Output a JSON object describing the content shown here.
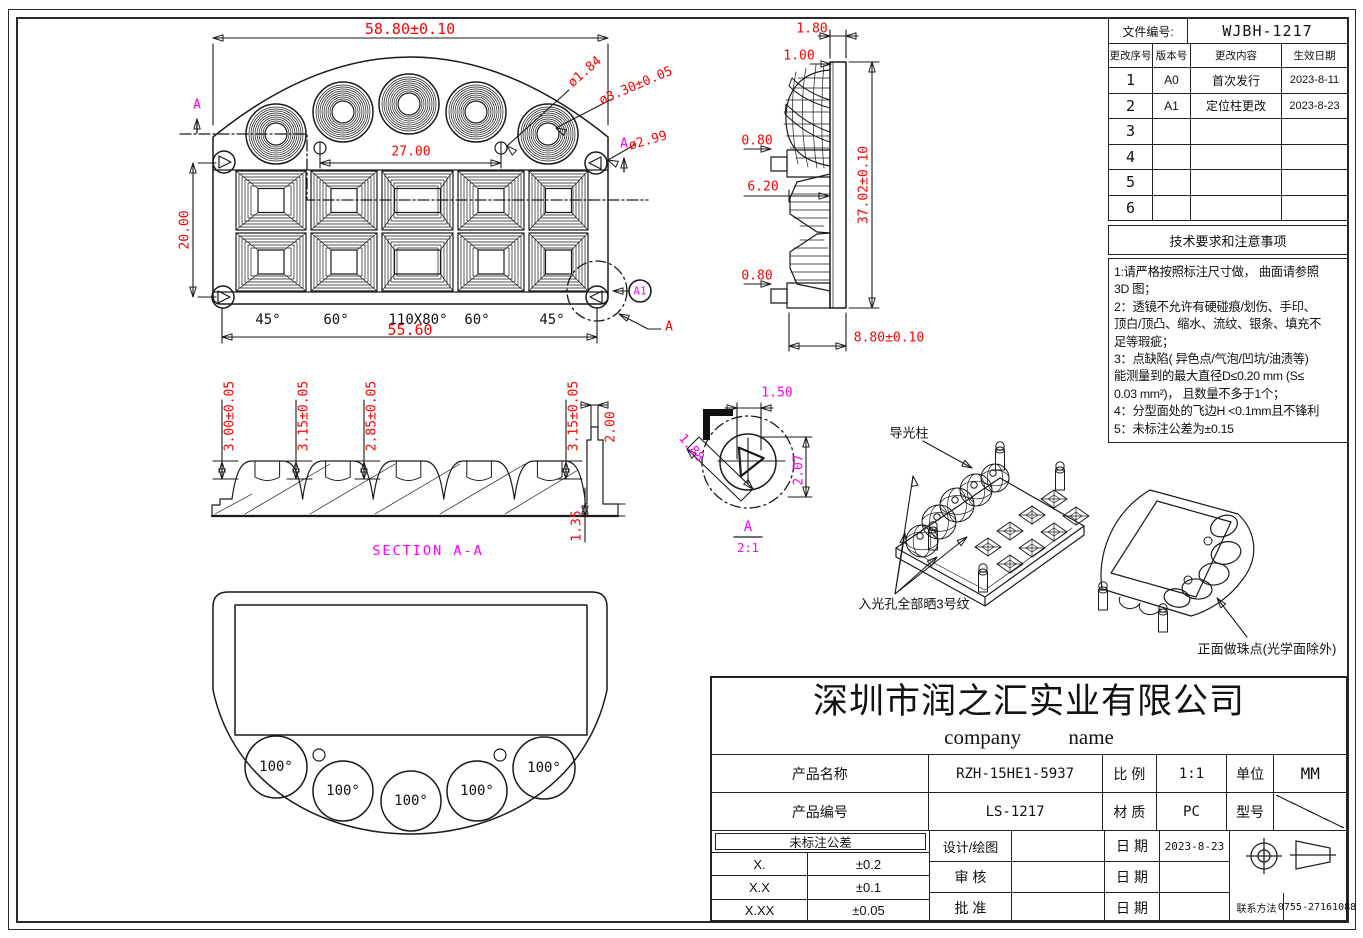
{
  "file_block": {
    "label": "文件编号:",
    "value": "WJBH-1217"
  },
  "revision": {
    "headers": [
      "更改序号",
      "版本号",
      "更改内容",
      "生效日期"
    ],
    "rows": [
      {
        "no": "1",
        "ver": "A0",
        "content": "首次发行",
        "date": "2023-8-11"
      },
      {
        "no": "2",
        "ver": "A1",
        "content": "定位柱更改",
        "date": "2023-8-23"
      },
      {
        "no": "3",
        "ver": "",
        "content": "",
        "date": ""
      },
      {
        "no": "4",
        "ver": "",
        "content": "",
        "date": ""
      },
      {
        "no": "5",
        "ver": "",
        "content": "",
        "date": ""
      },
      {
        "no": "6",
        "ver": "",
        "content": "",
        "date": ""
      }
    ]
  },
  "tech_notes": {
    "title": "技术要求和注意事项",
    "lines": [
      "1:请严格按照标注尺寸做， 曲面请参照",
      "3D 图；",
      "2：透镜不允许有硬碰痕/划伤、手印、",
      "顶白/顶凸、缩水、流纹、银条、填充不",
      "足等瑕疵；",
      "3：点缺陷( 异色点/气泡/凹坑/油渍等)",
      "能测量到的最大直径D≤0.20 mm (S≤",
      "0.03 mm²)，  且数量不多于1个；",
      "4：分型面处的飞边H <0.1mm且不锋利",
      "5：未标注公差为±0.15"
    ]
  },
  "title_block": {
    "company_cn": "深圳市润之汇实业有限公司",
    "company_en": "company name",
    "product_name_label": "产品名称",
    "product_name": "RZH-15HE1-5937",
    "scale_label": "比 例",
    "scale": "1:1",
    "unit_label": "单位",
    "unit": "MM",
    "product_no_label": "产品编号",
    "product_no": "LS-1217",
    "material_label": "材 质",
    "material": "PC",
    "model_label": "型号",
    "tolerance_title": "未标注公差",
    "tol_1_label": "X.",
    "tol_1": "±0.2",
    "tol_2_label": "X.X",
    "tol_2": "±0.1",
    "tol_3_label": "X.XX",
    "tol_3": "±0.05",
    "design_label": "设计/绘图",
    "check_label": "审 核",
    "approve_label": "批 准",
    "date_label": "日 期",
    "design_date": "2023-8-23",
    "contact_label": "联系方法",
    "contact": "0755-27161088"
  },
  "dims": {
    "top_width": "58.80±0.10",
    "top_pitch": "27.00",
    "top_height": "20.00",
    "top_width2": "55.60",
    "top_d1": "ø1.84",
    "top_d2": "ø3.30±0.05",
    "top_d3": "ø2.99",
    "angle_1": "45°",
    "angle_2": "60°",
    "angle_3": "110X80°",
    "angle_4": "60°",
    "angle_5": "45°",
    "sec_h1": "3.00±0.05",
    "sec_h2": "3.15±0.05",
    "sec_h3": "2.85±0.05",
    "sec_h4": "3.15±0.05",
    "sec_w": "2.00",
    "sec_t": "1.35",
    "side_1": "1.80",
    "side_2": "1.00",
    "side_3": "0.80",
    "side_4": "6.20",
    "side_5": "0.80",
    "side_h": "37.02±0.10",
    "side_d": "8.80±0.10",
    "det_1": "1.50",
    "det_2": "1.88",
    "det_3": "2.07",
    "bottom_angle": "100°"
  },
  "labels": {
    "section": "SECTION A-A",
    "detail_name": "A",
    "detail_scale": "2:1",
    "balloon": "A1",
    "detail_ref": "A",
    "section_marker": "A"
  },
  "notes": {
    "pillar": "导光柱",
    "holes": "入光孔全部晒3号纹",
    "front": "正面做珠点(光学面除外)"
  },
  "colors": {
    "dimension": "#ff0000",
    "section": "#ff00ff",
    "detail_circle": "#00c8e6"
  }
}
